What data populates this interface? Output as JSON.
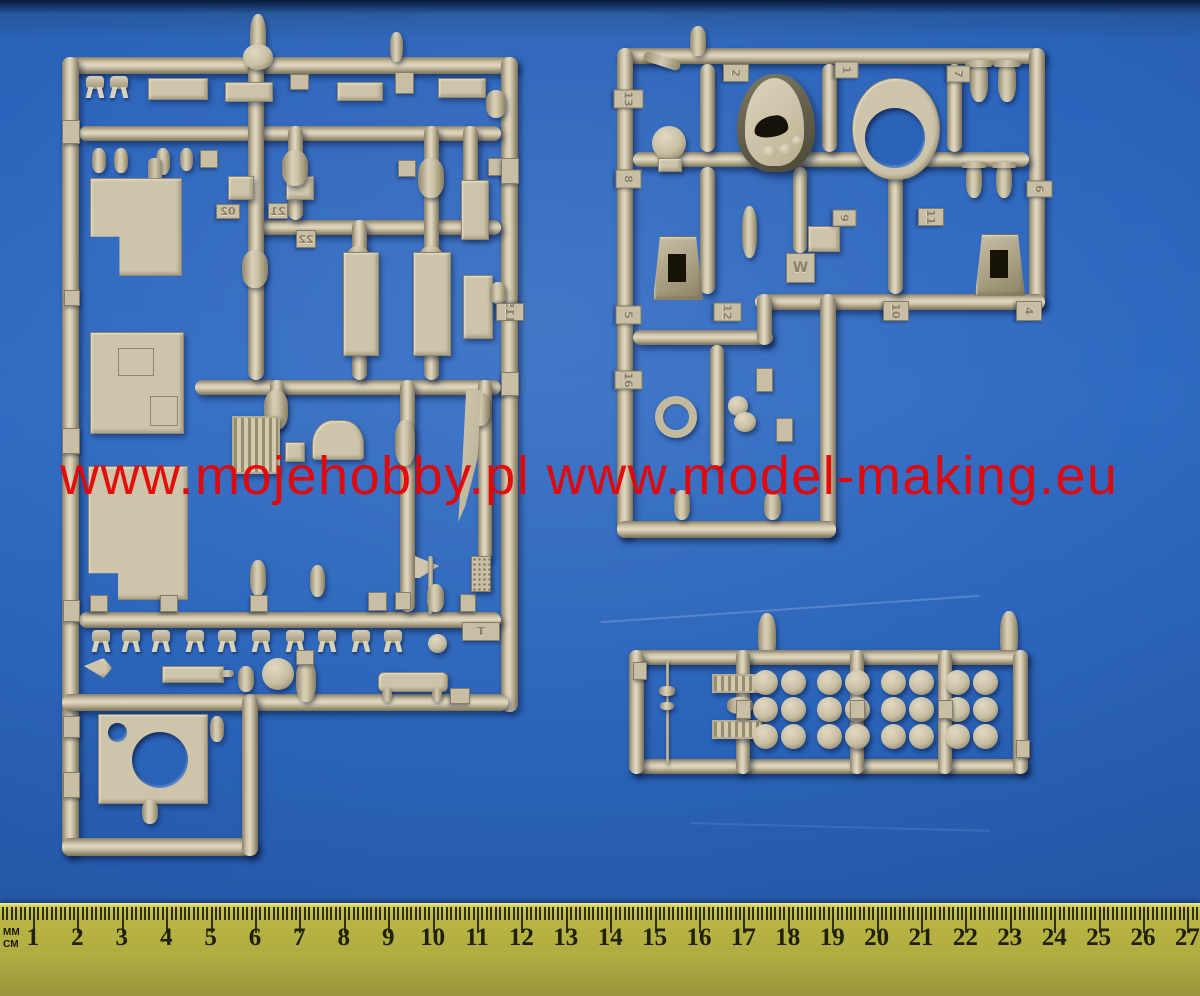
{
  "watermark": {
    "text": "www.mojehobby.pl www.model-making.eu",
    "color": "#e60404"
  },
  "ruler": {
    "unit_top": "MM",
    "unit_bottom": "CM",
    "cm_numbers": [
      1,
      2,
      3,
      4,
      5,
      6,
      7,
      8,
      9,
      10,
      11,
      12,
      13,
      14,
      15,
      16,
      17,
      18,
      19,
      20,
      21,
      22,
      23,
      24,
      25,
      26,
      27
    ]
  },
  "sprue_labels": {
    "left": {
      "l21": "21",
      "l22": "22",
      "l02": "02",
      "l115": "115",
      "lT": "T"
    },
    "right_top": {
      "t13": "13",
      "t8": "8",
      "t5": "5",
      "t2": "2",
      "t1": "1",
      "t7": "7",
      "t6": "6",
      "t9": "9",
      "t11": "11",
      "t12": "12",
      "tW": "W",
      "t10": "10",
      "t4": "4",
      "t16": "16"
    }
  },
  "colors": {
    "background_blue": "#2a63b8",
    "plastic_tan": "#cbc2a7",
    "watermark_red": "#e60404",
    "ruler_yellow": "#b0ad41"
  }
}
